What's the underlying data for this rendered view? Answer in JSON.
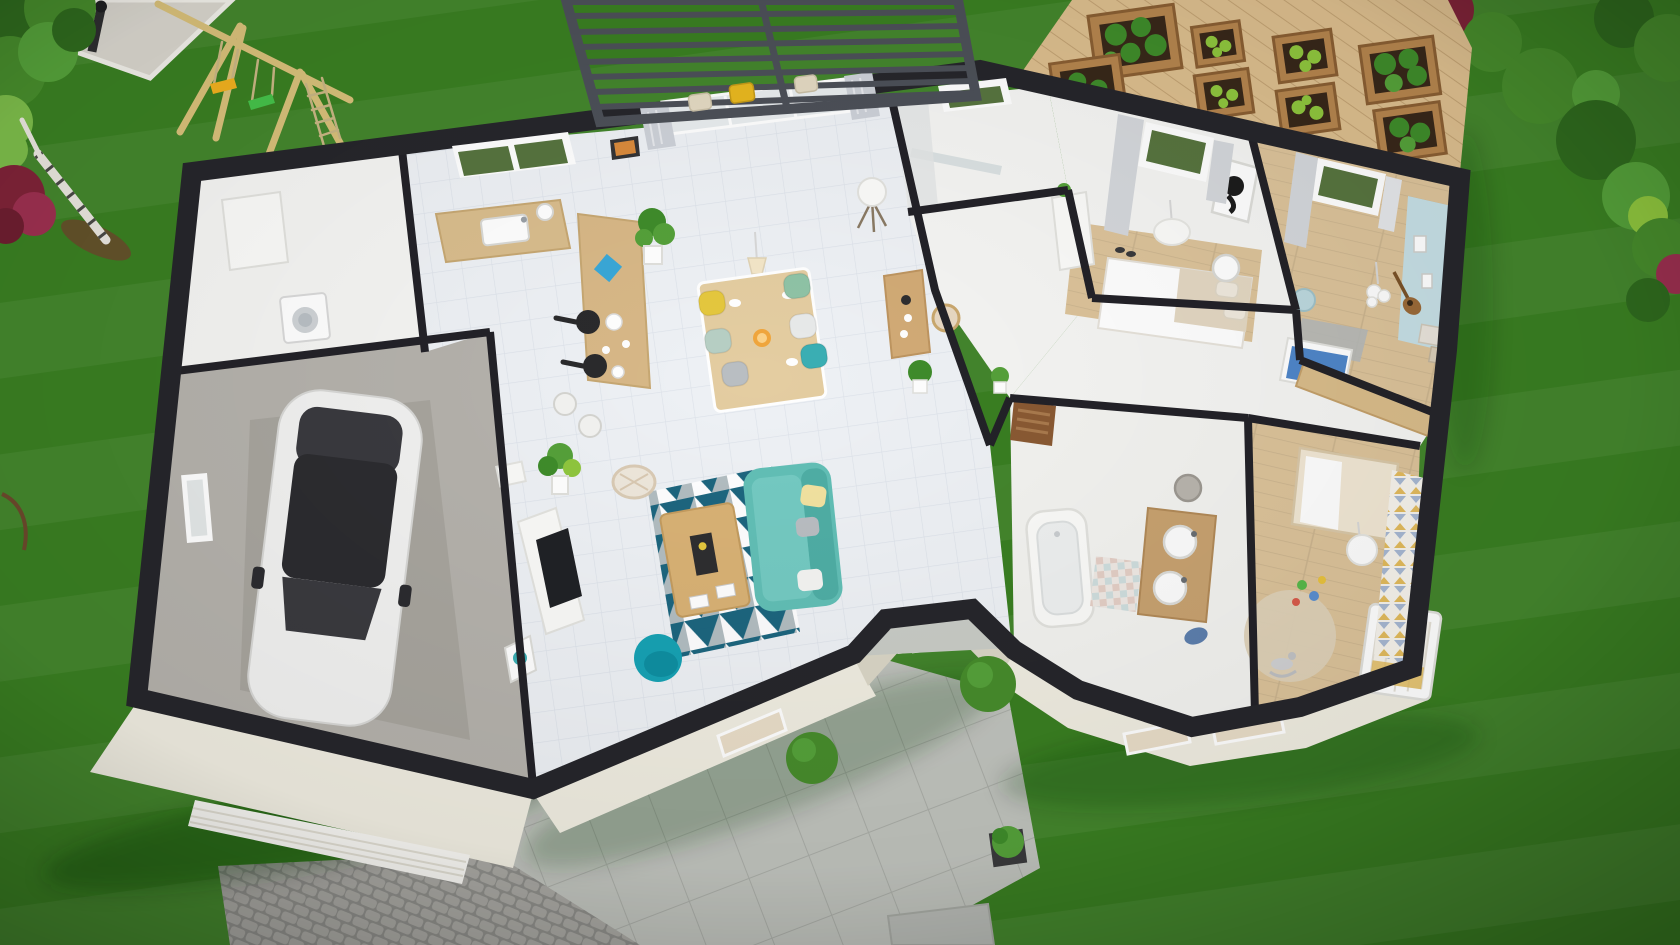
{
  "meta": {
    "description": "Aerial 3D cutaway floor-plan render of a single-storey house in a green garden",
    "canvas": {
      "width": 1680,
      "height": 945
    }
  },
  "palette": {
    "grass": "#3A7F22",
    "gravel": "#D8D5CD",
    "gravelEdge": "#F0EEE8",
    "cobbleBase": "#8E8E8A",
    "cobbleStone": "#A9A8A3",
    "patioBase": "#C1C4BE",
    "patioLine": "#ABAEA8",
    "paver": "#B9BCB7",
    "deckWood": "#DCBE8E",
    "deckLine": "#C2A273",
    "planterWood": "#B5854E",
    "planterEdge": "#8A5F33",
    "soil": "#38281A",
    "plantDark": "#3F8C2B",
    "plantMid": "#55A13A",
    "plantLight": "#8FC63E",
    "bushGreen": "#478C2C",
    "bushDeep": "#2F6A1E",
    "bushLight": "#7CBB4A",
    "bushRed": "#7E2338",
    "bushRedLight": "#9C3050",
    "birch": "#E8E5DE",
    "dirt": "#6B4A2C",
    "swingWood": "#D8C07A",
    "ropeTan": "#C9B684",
    "seatYellow": "#F0B01F",
    "seatGreen": "#46C24A",
    "pergola": "#4C5058",
    "wallCut": "#26262B",
    "wallInt": "#232228",
    "facade": "#F0EDE1",
    "facadeShade": "#DAD6C6",
    "garageDoor": "#F8F7F3",
    "garageFloor": "#B5B2AC",
    "tile": "#EEF1F5",
    "tileLine": "#DDE2EA",
    "floorWhite": "#F5F5F3",
    "woodFloor": "#DCC39A",
    "counterWood": "#D9BD8D",
    "islandWood": "#D8B887",
    "tableWood": "#E4CDA1",
    "coffeeWood": "#D9B275",
    "sideboardWood": "#D2AB76",
    "vanityWood": "#C8A270",
    "doorWood": "#8A5A33",
    "doorSlat": "#A97A4E",
    "frontDoor": "#7A4A28",
    "sofaTeal": "#62BFB6",
    "sofaTealDark": "#4FAEA5",
    "armTeal": "#17A2B4",
    "rugTeal": "#14607A",
    "rugGray": "#A8B4B8",
    "chairYellow": "#E5C83E",
    "chairGreen": "#8FC3A6",
    "chairMint": "#B7CFC4",
    "chairWhite": "#E8EAEA",
    "chairTeal": "#3AAFB4",
    "chairGray": "#B9BEC2",
    "curtain": "#CDD1D8",
    "glass": "#E8ECEE",
    "glassGreen": "#57743F",
    "white": "#FBFBF9",
    "tvDark": "#202226",
    "black": "#1C1C1C",
    "bedBeige": "#E3D7C2",
    "blueWall": "#C6DFE5",
    "blanketBlue": "#4F86C9",
    "wpYellow": "#E0B54E",
    "wpBlue": "#93A9CC",
    "rugBeige": "#DED2B8",
    "basket": "#B9B5AE",
    "towelBlue": "#5D7FAE",
    "carWhite": "#F2F2F1",
    "carGlass": "#3A3A3F",
    "blueDecor": "#3AA8D8",
    "orange": "#F0A63C"
  },
  "scene": {
    "environment": {
      "lawn": "grass-lawn",
      "gravel_patch": "gravel-corner-patch-with-lamp",
      "swing_set": "wooden-swing-set-yellow-and-green-seats",
      "vegetable_garden": "raised-planter-boxes-on-wood-deck",
      "pergola": "slatted-pergola-over-terrace",
      "driveway": "cobblestone-driveway",
      "patio": "tiled-patio",
      "shrubs": "green-and-red-garden-shrubs"
    },
    "house": {
      "style": "single-storey-cutaway-floor-plan",
      "rooms": [
        {
          "id": "garage",
          "items": [
            "white-car",
            "window"
          ]
        },
        {
          "id": "laundry",
          "items": [
            "washing-machine",
            "cabinet"
          ]
        },
        {
          "id": "kitchen",
          "items": [
            "window",
            "counter-with-sink",
            "island-bar",
            "stools",
            "pans",
            "plant"
          ]
        },
        {
          "id": "dining",
          "items": [
            "wood-table",
            "six-colored-chairs",
            "fruit-bowl",
            "pendant-light"
          ]
        },
        {
          "id": "living",
          "items": [
            "teal-sofa",
            "geometric-rug",
            "coffee-table",
            "teal-armchair",
            "tv-unit",
            "sideboard",
            "floor-lamp",
            "plants",
            "sliding-glass-door-with-curtains"
          ]
        },
        {
          "id": "shower-room",
          "items": [
            "window",
            "glass-screen"
          ]
        },
        {
          "id": "hallway",
          "items": [
            "wooden-door",
            "plant"
          ]
        },
        {
          "id": "master-bedroom",
          "items": [
            "double-bed",
            "window-with-curtains",
            "panda-artwork",
            "pendant-lamp",
            "dresser",
            "side-table"
          ]
        },
        {
          "id": "bedroom",
          "items": [
            "window-with-curtains",
            "light-blue-accent-wall",
            "bed-with-blue-blanket",
            "guitar",
            "gray-rug",
            "desk",
            "storage-boxes",
            "pendant-lamp"
          ]
        },
        {
          "id": "bathroom",
          "items": [
            "bathtub",
            "double-sink-vanity",
            "laundry-basket",
            "rug",
            "towel",
            "wooden-door"
          ]
        },
        {
          "id": "nursery",
          "items": [
            "crib",
            "round-rug",
            "rocking-horse",
            "toys",
            "patterned-wallpaper",
            "toddler-bed",
            "pendant-lamp"
          ]
        },
        {
          "id": "entrance",
          "items": [
            "recessed-porch",
            "front-door",
            "two-round-bushes"
          ]
        }
      ]
    }
  }
}
